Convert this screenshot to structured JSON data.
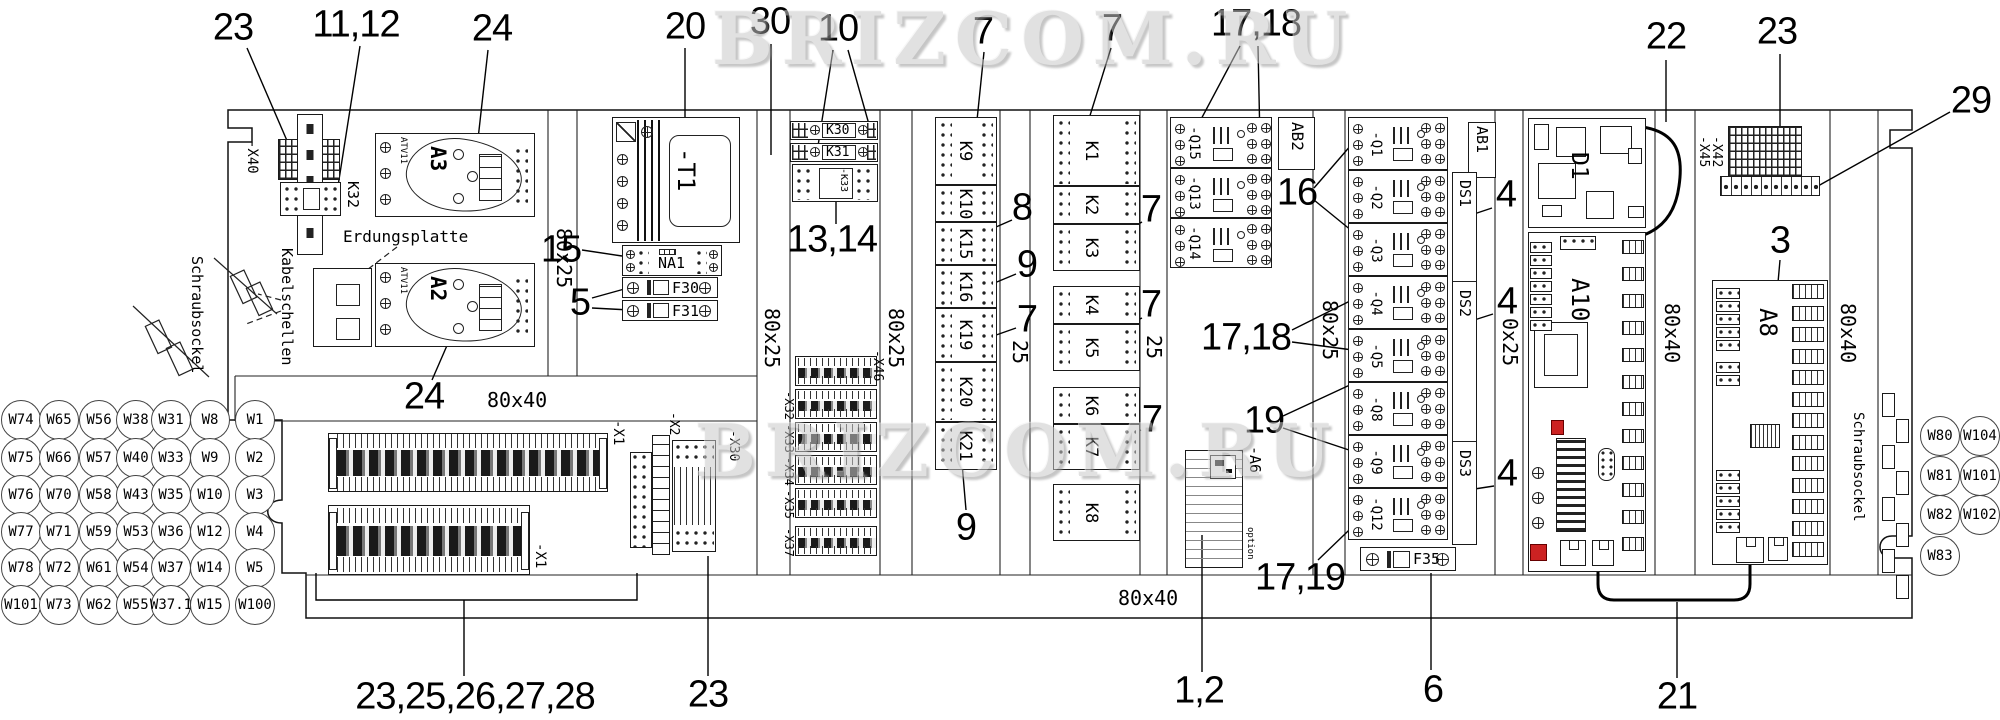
{
  "watermarks": {
    "top": "BRIZCOM.RU",
    "middle": "BRIZCOM.RU"
  },
  "texts": {
    "erdungsplatte": "Erdungsplatte",
    "kabelschellen": "Kabelschellen",
    "schraubsockel_left": "Schraubsockel",
    "schraubsockel_right": "Schraubsockel"
  },
  "ducts": [
    {
      "text": "80x25",
      "x": 552,
      "y": 228,
      "dir": "v"
    },
    {
      "text": "80x25",
      "x": 760,
      "y": 308,
      "dir": "v"
    },
    {
      "text": "80x25",
      "x": 884,
      "y": 308,
      "dir": "v"
    },
    {
      "text": "25",
      "x": 1008,
      "y": 340,
      "dir": "v"
    },
    {
      "text": "25",
      "x": 1142,
      "y": 335,
      "dir": "v"
    },
    {
      "text": "80x25",
      "x": 1318,
      "y": 300,
      "dir": "v"
    },
    {
      "text": "0x25",
      "x": 1498,
      "y": 318,
      "dir": "v"
    },
    {
      "text": "80x40",
      "x": 1660,
      "y": 303,
      "dir": "v"
    },
    {
      "text": "80x40",
      "x": 1836,
      "y": 303,
      "dir": "v"
    },
    {
      "text": "80x40",
      "x": 487,
      "y": 388,
      "dir": "h"
    },
    {
      "text": "80x40",
      "x": 1118,
      "y": 586,
      "dir": "h"
    }
  ],
  "callouts": [
    {
      "text": "23",
      "x": 233,
      "y": 28
    },
    {
      "text": "11,12",
      "x": 356,
      "y": 25
    },
    {
      "text": "24",
      "x": 492,
      "y": 29
    },
    {
      "text": "20",
      "x": 685,
      "y": 27
    },
    {
      "text": "30",
      "x": 770,
      "y": 22
    },
    {
      "text": "10",
      "x": 838,
      "y": 29
    },
    {
      "text": "7",
      "x": 983,
      "y": 32
    },
    {
      "text": "7",
      "x": 1112,
      "y": 29
    },
    {
      "text": "17,18",
      "x": 1256,
      "y": 24
    },
    {
      "text": "22",
      "x": 1666,
      "y": 37
    },
    {
      "text": "23",
      "x": 1777,
      "y": 32
    },
    {
      "text": "29",
      "x": 1971,
      "y": 101
    },
    {
      "text": "15",
      "x": 561,
      "y": 250
    },
    {
      "text": "5",
      "x": 580,
      "y": 303
    },
    {
      "text": "13,14",
      "x": 832,
      "y": 240
    },
    {
      "text": "8",
      "x": 1022,
      "y": 208
    },
    {
      "text": "9",
      "x": 1027,
      "y": 265
    },
    {
      "text": "7",
      "x": 1027,
      "y": 320
    },
    {
      "text": "7",
      "x": 1151,
      "y": 210
    },
    {
      "text": "7",
      "x": 1151,
      "y": 305
    },
    {
      "text": "7",
      "x": 1152,
      "y": 420
    },
    {
      "text": "9",
      "x": 966,
      "y": 528
    },
    {
      "text": "16",
      "x": 1297,
      "y": 193
    },
    {
      "text": "17,18",
      "x": 1246,
      "y": 338
    },
    {
      "text": "19",
      "x": 1264,
      "y": 421
    },
    {
      "text": "17,19",
      "x": 1300,
      "y": 578
    },
    {
      "text": "4",
      "x": 1506,
      "y": 195
    },
    {
      "text": "4",
      "x": 1507,
      "y": 302
    },
    {
      "text": "4",
      "x": 1507,
      "y": 474
    },
    {
      "text": "3",
      "x": 1780,
      "y": 241
    },
    {
      "text": "24",
      "x": 424,
      "y": 397
    },
    {
      "text": "23,25,26,27,28",
      "x": 475,
      "y": 697
    },
    {
      "text": "23",
      "x": 708,
      "y": 695
    },
    {
      "text": "1,2",
      "x": 1199,
      "y": 691
    },
    {
      "text": "6",
      "x": 1433,
      "y": 690
    },
    {
      "text": "21",
      "x": 1677,
      "y": 697
    }
  ],
  "components": {
    "x40": "-X40",
    "k32": "K32",
    "a3": "A3",
    "a3_type": "ATV11",
    "a2": "A2",
    "a2_type": "ATV11",
    "t1": "-T1",
    "na1": "NA1",
    "f30": "F30",
    "f31": "F31",
    "f35": "F35",
    "k30": "K30",
    "k31": "K31",
    "k33": "-K33",
    "relays_col1": [
      "K9",
      "K10",
      "K15",
      "K16",
      "K19",
      "K20",
      "K21"
    ],
    "relays_col2": [
      "K1",
      "K2",
      "K3",
      "K4",
      "K5",
      "K6",
      "K7",
      "K8"
    ],
    "breakers_col1": [
      "-Q15",
      "-Q13",
      "-Q14"
    ],
    "breakers_col2": [
      "-Q1",
      "-Q2",
      "-Q3",
      "-Q4",
      "-Q5",
      "-Q8",
      "-Q9",
      "-Q12"
    ],
    "ab2": "AB2",
    "ab1": "AB1",
    "ds": [
      "DS1",
      "DS2",
      "DS3"
    ],
    "a6": "-A6",
    "a6_note": "option",
    "d1": "D1",
    "a10": "A10",
    "a8": "A8",
    "x45": "-X45",
    "x42": "-X42",
    "x1_top": "-X1",
    "x1_bottom": "-X1",
    "x2": "-X2",
    "x30": "-X30",
    "x46": "-X46",
    "x_stack": [
      "-X32",
      "-X33",
      "-X34",
      "-X35",
      "-X37"
    ]
  },
  "wire_labels_left": [
    [
      "W74",
      "W65",
      "W56",
      "W38",
      "W31",
      "W8",
      "W1"
    ],
    [
      "W75",
      "W66",
      "W57",
      "W40",
      "W33",
      "W9",
      "W2"
    ],
    [
      "W76",
      "W70",
      "W58",
      "W43",
      "W35",
      "W10",
      "W3"
    ],
    [
      "W77",
      "W71",
      "W59",
      "W53",
      "W36",
      "W12",
      "W4"
    ],
    [
      "W78",
      "W72",
      "W61",
      "W54",
      "W37",
      "W14",
      "W5"
    ],
    [
      "W101",
      "W73",
      "W62",
      "W55",
      "W37.1",
      "W15",
      "W100"
    ]
  ],
  "wire_labels_right": [
    [
      "W80",
      "W104"
    ],
    [
      "W81",
      "W101"
    ],
    [
      "W82",
      "W102"
    ],
    [
      "W83"
    ]
  ]
}
